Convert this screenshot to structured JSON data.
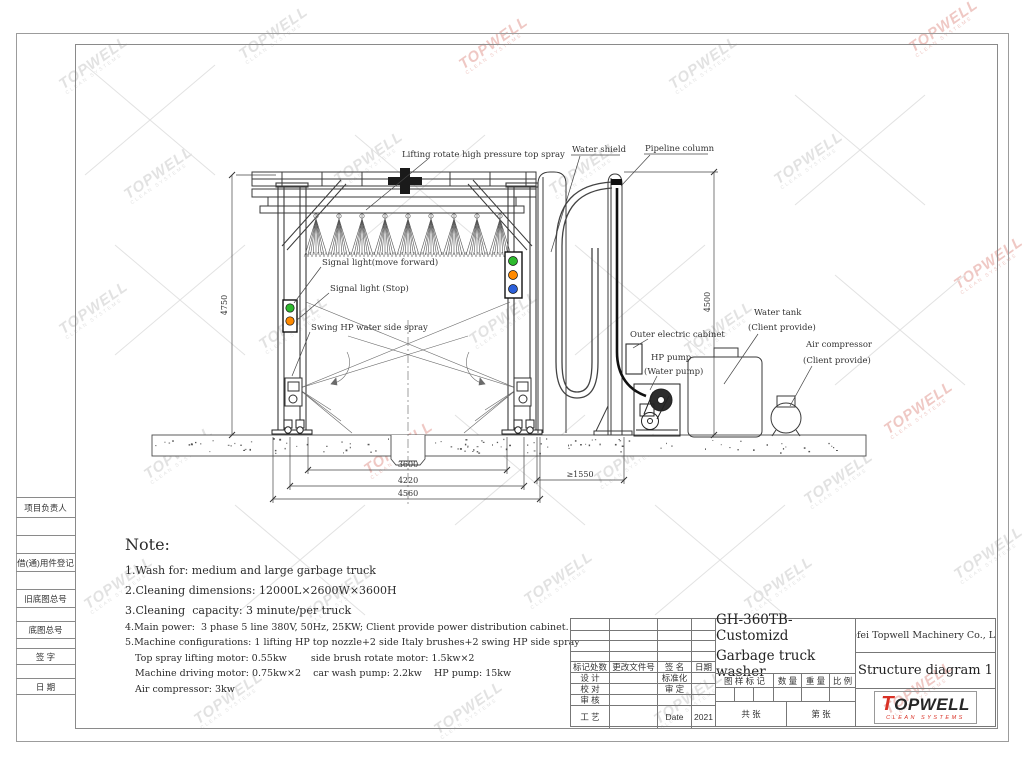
{
  "watermark": {
    "text": "TOPWELL",
    "sub": "CLEAN SYSTEMS"
  },
  "left_strip": {
    "rows": [
      "项目负责人",
      "",
      "",
      "借(通)用件登记",
      "",
      "旧底图总号",
      "",
      "底图总号",
      "",
      "签  字",
      "",
      "日  期",
      ""
    ]
  },
  "drawing": {
    "labels": {
      "top_spray": "Lifting rotate high pressure top spray",
      "water_shield": "Water shield",
      "pipeline_column": "Pipeline column",
      "signal_forward": "Signal light(move forward)",
      "signal_stop": "Signal light (Stop)",
      "swing_spray": "Swing HP water side spray",
      "outer_cabinet": "Outer electric cabinet",
      "hp_pump_1": "HP pump",
      "hp_pump_2": "(Water pump)",
      "water_tank_1": "Water tank",
      "water_tank_2": "(Client provide)",
      "air_compressor_1": "Air compressor",
      "air_compressor_2": "(Client provide)"
    },
    "dimensions": {
      "height_left": "4750",
      "height_right": "4500",
      "width_inner": "3600",
      "width_mid": "4220",
      "width_outer": "4560",
      "clearance": "≥1550"
    },
    "status_colors": {
      "green": "#2db92d",
      "orange": "#ff8a00",
      "blue": "#2b5fd9"
    }
  },
  "note": {
    "title": "Note:",
    "line1": "1.Wash for: medium and large garbage truck",
    "line2": "2.Cleaning dimensions: 12000L×2600W×3600H",
    "line3": "3.Cleaning  capacity: 3 minute/per truck",
    "line4": "4.Main power:  3 phase 5 line 380V, 50Hz, 25KW; Client provide power distribution cabinet.",
    "line5": "5.Machine configurations: 1 lifting HP top nozzle+2 side Italy brushes+2 swing HP side spray",
    "line6": "Top spray lifting motor: 0.55kw        side brush rotate motor: 1.5kw×2",
    "line7": "Machine driving motor: 0.75kw×2    car wash pump: 2.2kw    HP pump: 15kw",
    "line8": "Air compressor: 3kw"
  },
  "title_block": {
    "rev_header": {
      "c1": "标记处数",
      "c2": "更改文件号",
      "c3": "签  名",
      "c4": "日期"
    },
    "sig_rows": [
      {
        "c1": "设  计",
        "c2": "",
        "c3": "标准化",
        "c4": ""
      },
      {
        "c1": "校  对",
        "c2": "",
        "c3": "审  定",
        "c4": ""
      },
      {
        "c1": "审  核",
        "c2": "",
        "c3": "",
        "c4": ""
      },
      {
        "c1": "工  艺",
        "c2": "",
        "c3": "Date",
        "c4": "2021"
      }
    ],
    "model": "GH-360TB-Customizd",
    "product": "Garbage truck washer",
    "mark_header": {
      "c1": "图 样 标 记",
      "c2": "数 量",
      "c3": "重 量",
      "c4": "比 例"
    },
    "sheets_total": "共        张",
    "sheet_no": "第        张",
    "company": "Hefei Topwell Machinery Co., Ltd.",
    "doc_title": "Structure diagram 1",
    "logo_word": "TOPWELL",
    "logo_sub": "CLEAN SYSTEMS",
    "logo_red": "#d93025"
  }
}
